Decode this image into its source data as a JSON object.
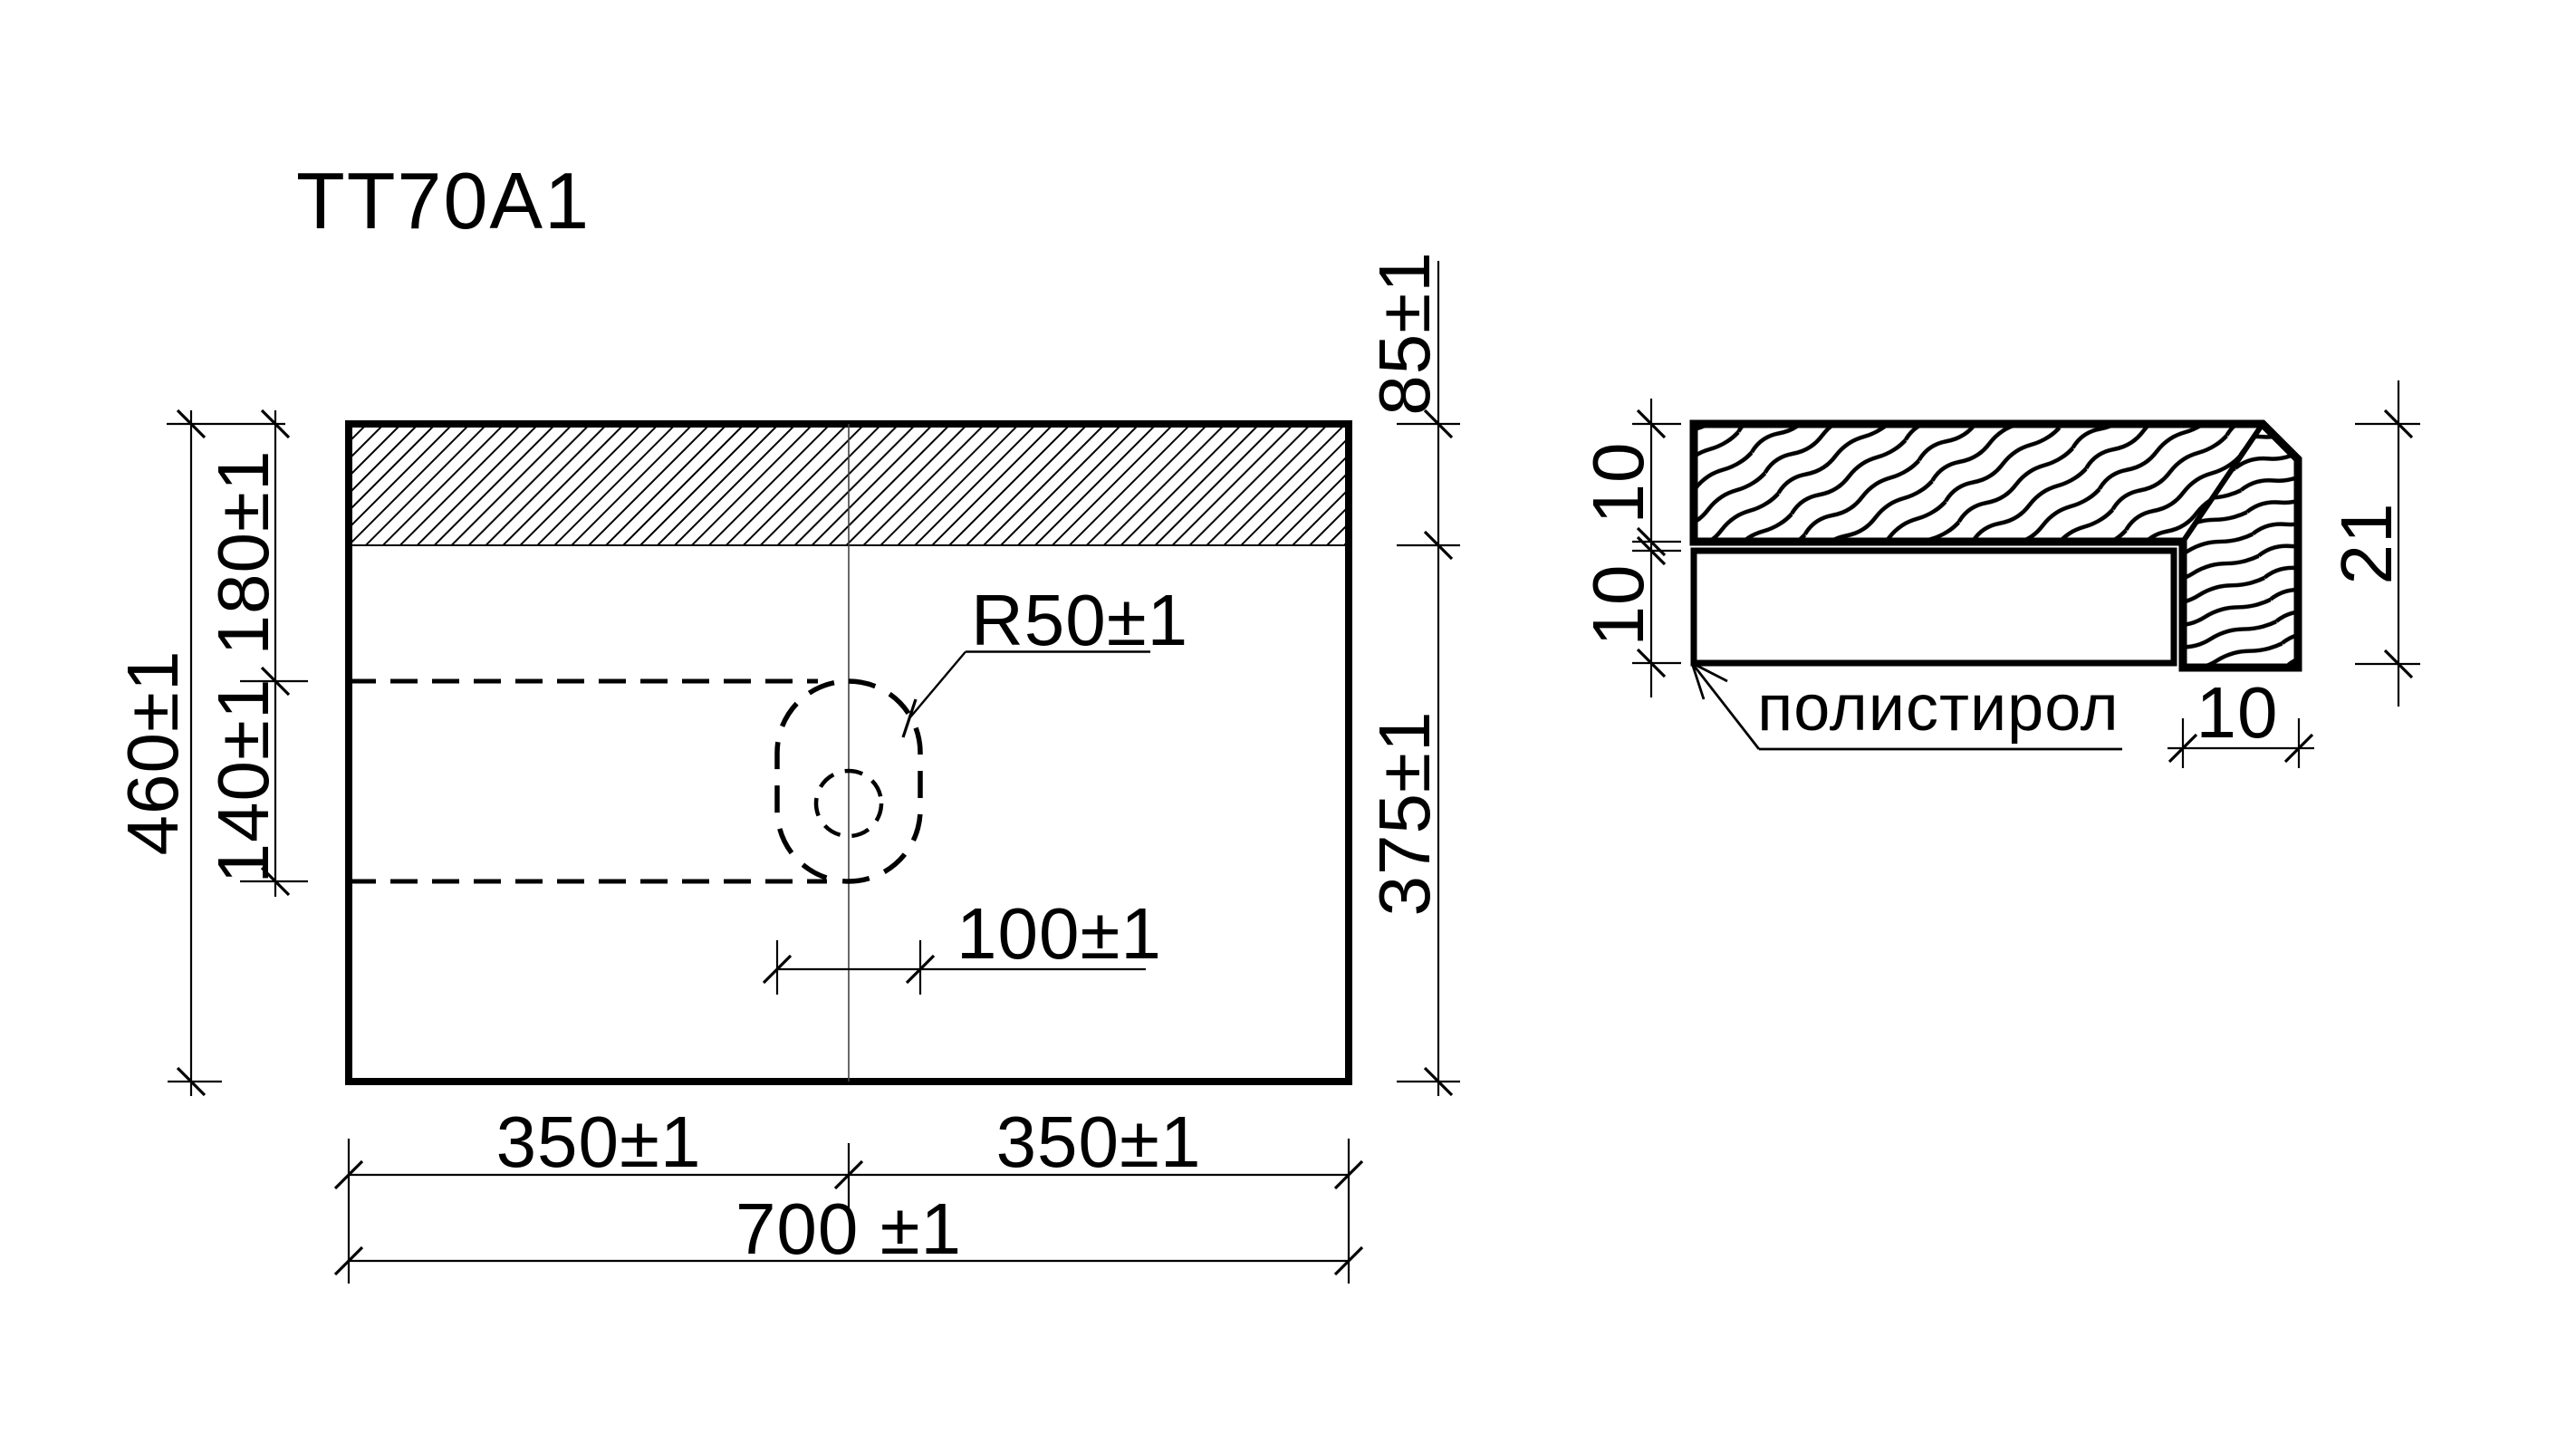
{
  "drawing": {
    "title": "TT70A1",
    "material_label": "полистирол",
    "plan_view": {
      "total_height": "460±1",
      "upper_offset": "180±1",
      "hole_span": "140±1",
      "back_band_height": "85±1",
      "front_height": "375±1",
      "hole_radius": "R50±1",
      "hole_width": "100±1",
      "left_half_width": "350±1",
      "right_half_width": "350±1",
      "total_width": "700 ±1"
    },
    "section_view": {
      "top_layer_thickness": "10",
      "bottom_layer_thickness": "10",
      "edge_total_height": "21",
      "edge_depth": "10"
    },
    "colors": {
      "ink": "#000000",
      "paper": "#ffffff"
    }
  }
}
